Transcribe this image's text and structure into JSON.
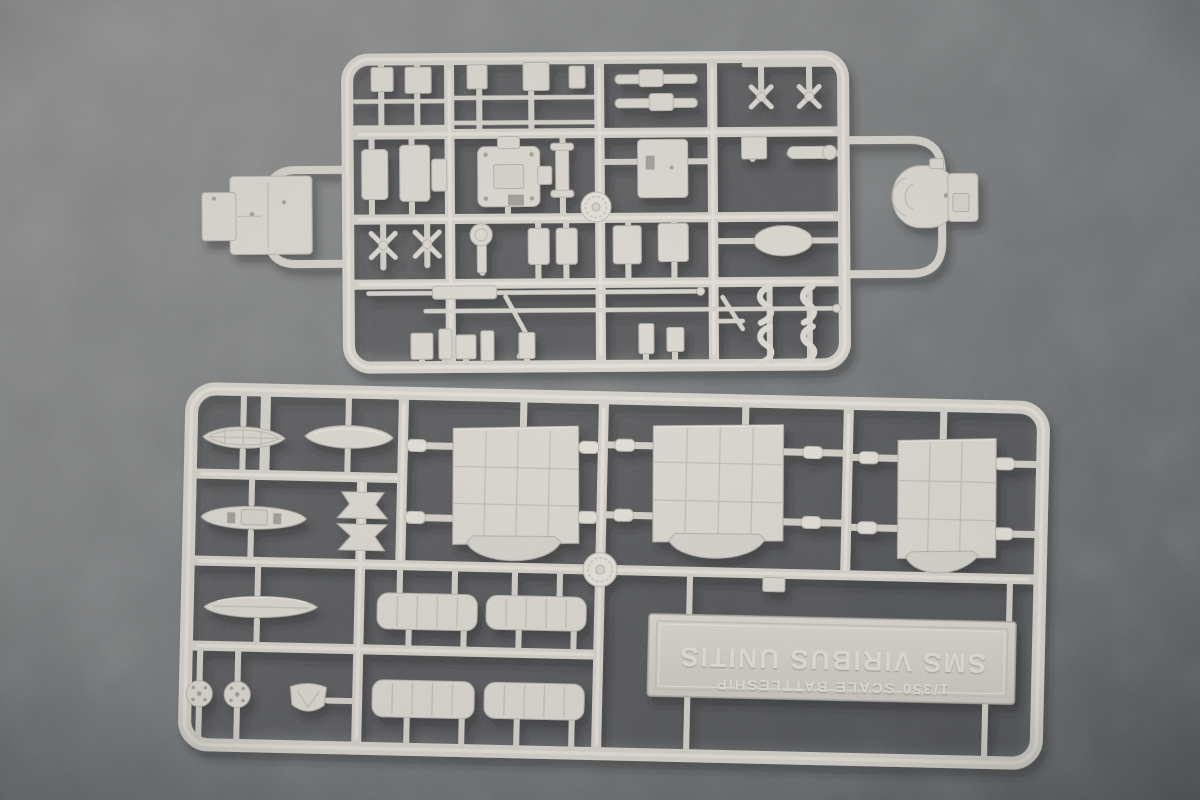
{
  "colors": {
    "felt_light": "#919190",
    "felt_mid": "#797c7e",
    "felt_dark": "#5d6165",
    "felt_shadow": "#3c3e40",
    "plastic": "#d9d6ce",
    "plastic_highlight": "#e9e6de",
    "plastic_shade": "#b5b2a9"
  },
  "nameplate": {
    "line1": "SMS  VIRIBUS UNITIS",
    "line2": "1/350 SCALE BATTLESHIP"
  }
}
